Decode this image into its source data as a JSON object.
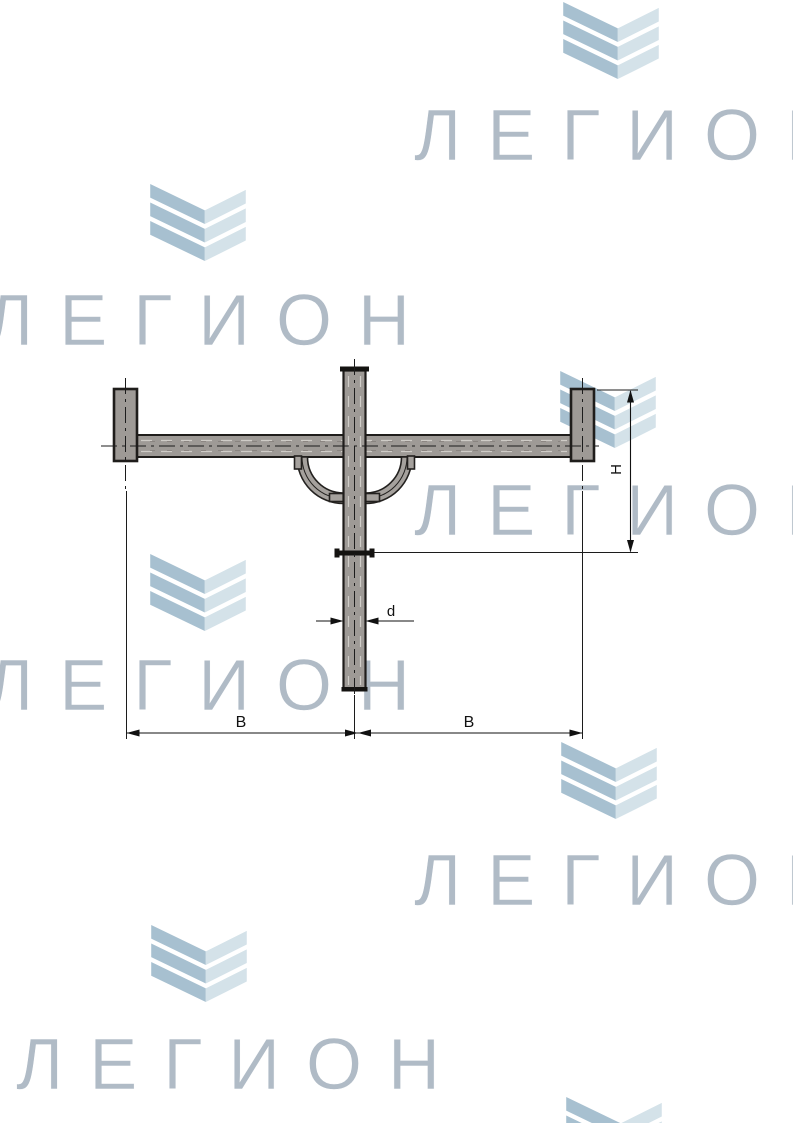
{
  "page": {
    "background_color": "#ffffff",
    "description": "Technical drawing of a two-arm pole cross-arm bracket over repeated brand watermark"
  },
  "watermark": {
    "brand_text": "ЛЕГИОН",
    "text_color": "#b0bbc6",
    "chevron_dark_color": "#a7c0d0",
    "chevron_light_color": "#d4e2e9"
  },
  "drawing": {
    "labels": {
      "span_left": "B",
      "span_right": "B",
      "post_diameter": "d",
      "flange_drop": "H"
    },
    "colors": {
      "part_fill": "#9e9a96",
      "outline": "#1f1d1b",
      "dimension": "#111111"
    }
  }
}
